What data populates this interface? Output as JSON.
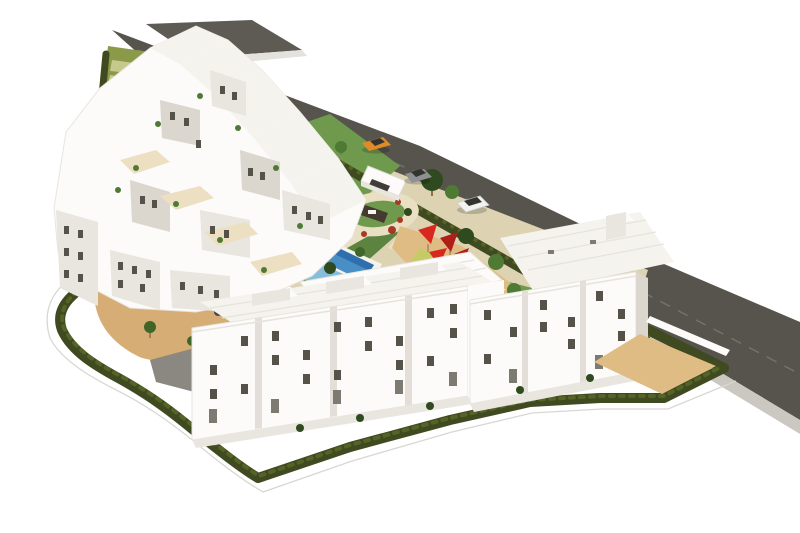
{
  "scene": {
    "type": "aerial-3d-architectural-render",
    "subject": "White Mediterranean-style residential apartment complex viewed from above at an angle, on a white background",
    "elements": {
      "road": "asphalt road running diagonally from upper-left to right edge with sidewalk",
      "northwest_building_cluster": "terraced cascading white apartment block with roof terraces and plants",
      "south_building_row": "two rectangular 4-5 storey white apartment blocks with scattered dark windows",
      "garden": "central communal garden with lawns and beige paths",
      "swimming_pool": "L-shaped blue lap pool with white deck and sun loungers",
      "kids_pool": "small secondary blue pool",
      "circular_plaza": "round landscaped plaza with dark monument wall and red flower beds",
      "playground": "kids playground with red shade sails and yellow-green safety mats",
      "stair_terraces": "green terraced slope with white staircase at top-left",
      "perimeter_hedge": "dark green hedge wrapping the south and west property boundary",
      "courtyard": "sand-coloured walled courtyard at the right enclosed by hedges",
      "cars": [
        "orange-car",
        "gray-car",
        "white-car"
      ],
      "entrance_gate": "white gated entrance canopy on the road"
    },
    "counts": {
      "apartment_blocks": 3,
      "pools": 2,
      "cars": 3
    }
  },
  "palette": {
    "background": "#ffffff",
    "road": "#57544e",
    "roof_strip": "#5e5b55",
    "curb": "#e4e2dd",
    "sidewalk": "#cbc8c2",
    "lane_line": "#75726b",
    "hedge": "#3f4a20",
    "hedge_light": "#566326",
    "perimeter_outline": "#d9d7d2",
    "slope": "#8a9a48",
    "slope_stripe": "#c7c98c",
    "stairs": "#f5f4ef",
    "lawn": "#6f9a4d",
    "lawn_dark": "#5c8440",
    "garden_base": "#ddd3b2",
    "path": "#e9dfc2",
    "sand": "#d6ad74",
    "sand_light": "#e0bc85",
    "paved": "#8b8781",
    "pool_deep": "#2f6fae",
    "pool": "#4a8ec6",
    "pool_light": "#85bedd",
    "deck": "#f6f3ec",
    "building": "#fcfbf9",
    "facade_shadow": "#e9e6e0",
    "facade_deep": "#dbd7cf",
    "roof_face": "#f5f3ee",
    "terrace_floor": "#ecdfc2",
    "parapet_line": "#e6e3dc",
    "window": "#55524a",
    "window_light": "#7d7a72",
    "divider": "#e3dfd8",
    "plant": "#4e7a33",
    "plant_dark": "#2f4a1e",
    "palm": "#3f6628",
    "trunk": "#8a6f4d",
    "shrub_red": "#a63a28",
    "shrub_purple": "#4a4458",
    "sail_red": "#d6281e",
    "sail_red_dark": "#b01f17",
    "mat_yellow": "#c7cb67",
    "mat_green": "#93a843",
    "monument": "#443a30",
    "car_orange": "#e08a28",
    "car_white": "#f2f2f0",
    "car_gray": "#8f9094",
    "car_window": "#33342f",
    "gate_dark": "#3f3d38",
    "shadow": "rgba(0,0,0,0.18)"
  }
}
